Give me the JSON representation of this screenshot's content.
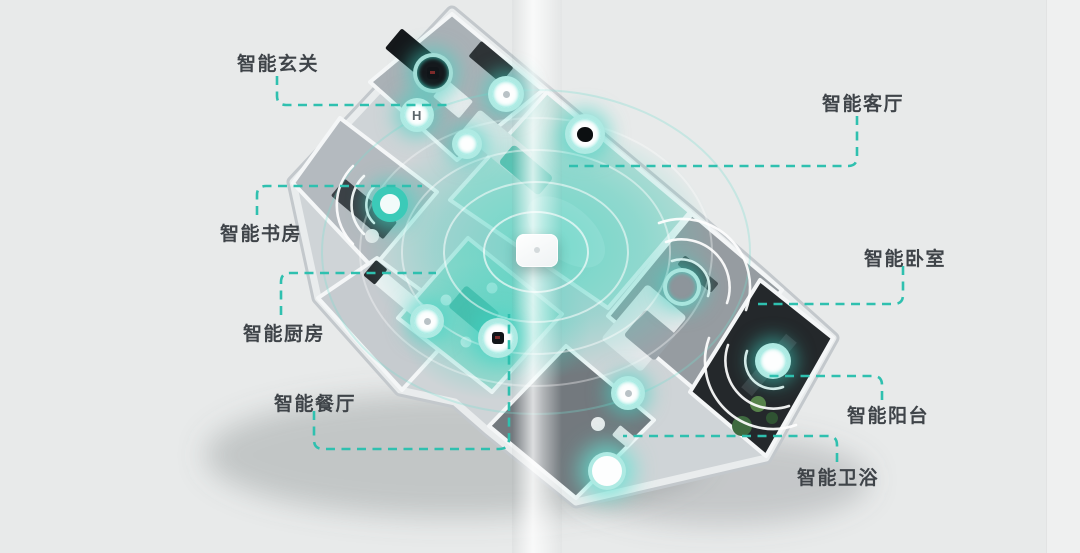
{
  "labels": {
    "entrance": "智能玄关",
    "living": "智能客厅",
    "study": "智能书房",
    "kitchen": "智能厨房",
    "dining": "智能餐厅",
    "bedroom": "智能卧室",
    "balcony": "智能阳台",
    "bathroom": "智能卫浴"
  },
  "device_icons": {
    "lock_glyph": "H",
    "list": [
      "wall-switch-icon",
      "door-lock-icon",
      "downlight-icon",
      "light-sensor-icon",
      "camera-icon",
      "speaker-icon",
      "kitchen-sensor-icon",
      "scene-switch-icon",
      "thermostat-icon",
      "balcony-light-icon",
      "bath-sensor-icon",
      "bath-light-icon",
      "gateway-hub"
    ]
  },
  "colors": {
    "accent_teal": "#2fc0af",
    "glow_teal": "#3ed6c5",
    "label_text": "#3f4449",
    "page_background": "#e8eaea",
    "balcony_dark": "#24282b"
  }
}
